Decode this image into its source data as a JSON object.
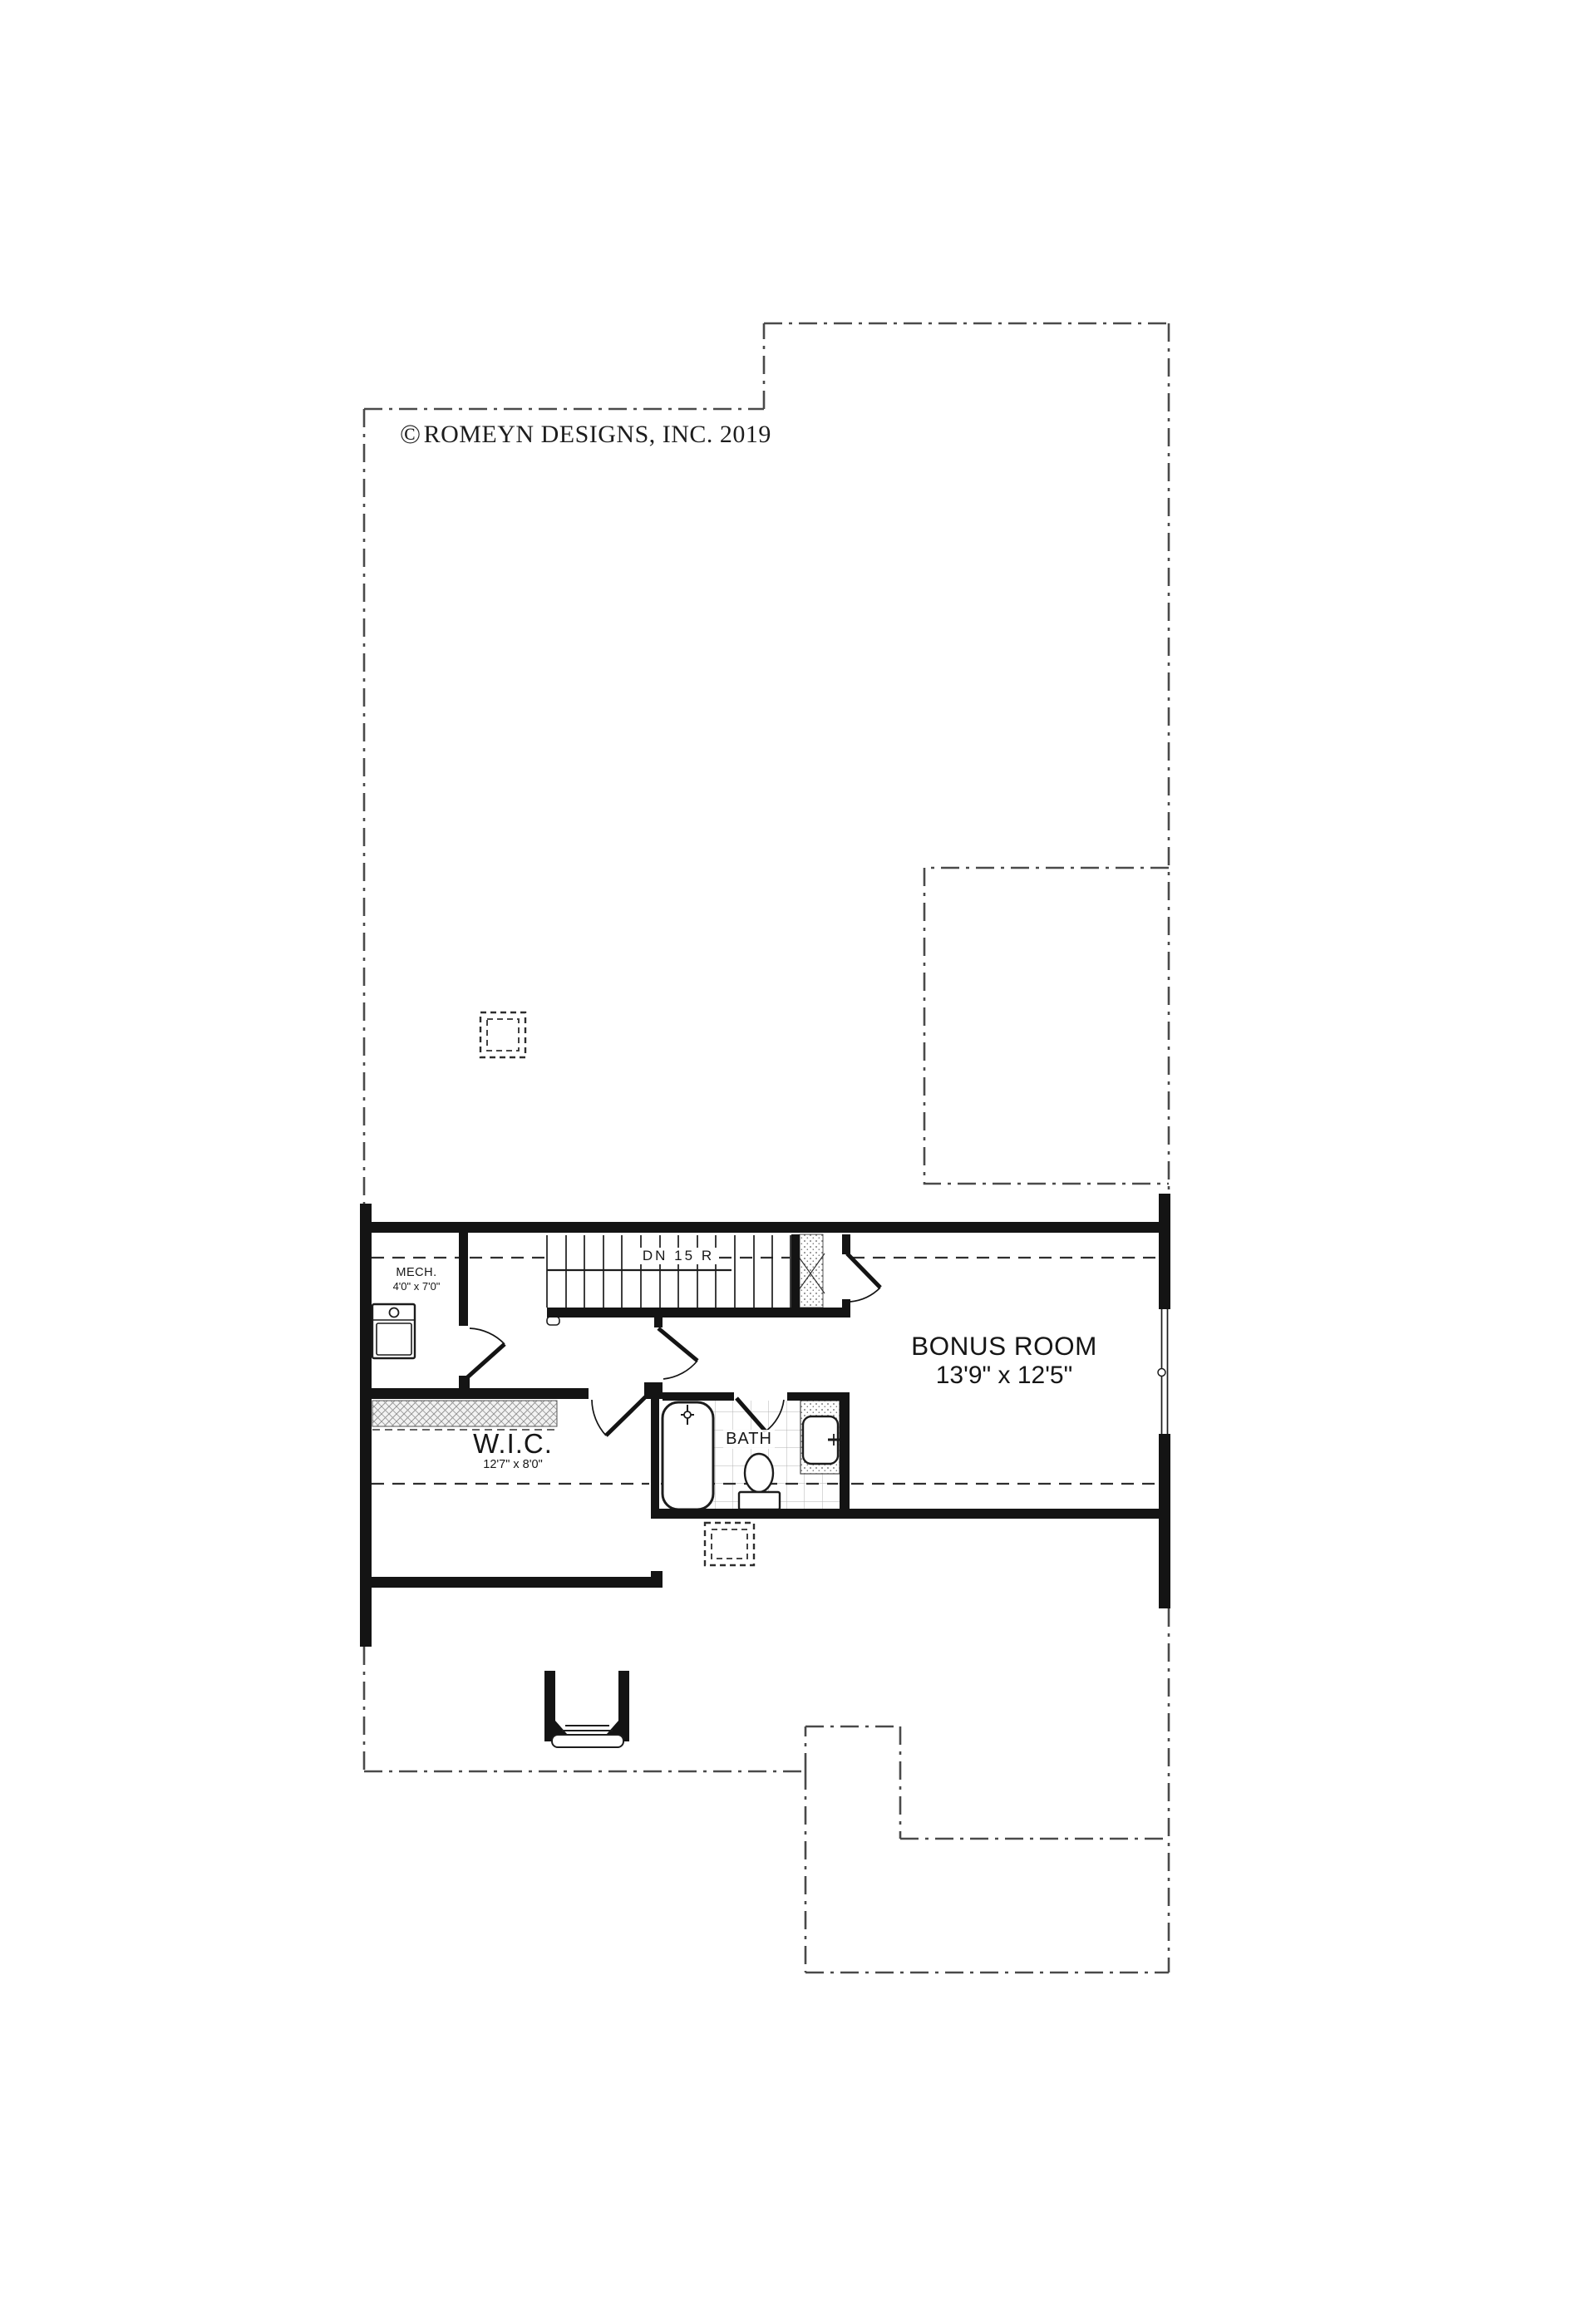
{
  "copyright": {
    "symbol": "©",
    "text": "ROMEYN DESIGNS, INC. 2019"
  },
  "stairs": {
    "label": "DN 15 R"
  },
  "rooms": {
    "bonus": {
      "name": "BONUS ROOM",
      "dimensions": "13'9\" x 12'5\""
    },
    "wic": {
      "name": "W.I.C.",
      "dimensions": "12'7\" x 8'0\""
    },
    "bath": {
      "name": "BATH"
    },
    "mech": {
      "name": "MECH.",
      "dimensions": "4'0\" x 7'0\""
    }
  },
  "colors": {
    "ink": "#141414",
    "outline_dash": "#4a4a4a",
    "tile_grid": "#b3b3b3"
  }
}
